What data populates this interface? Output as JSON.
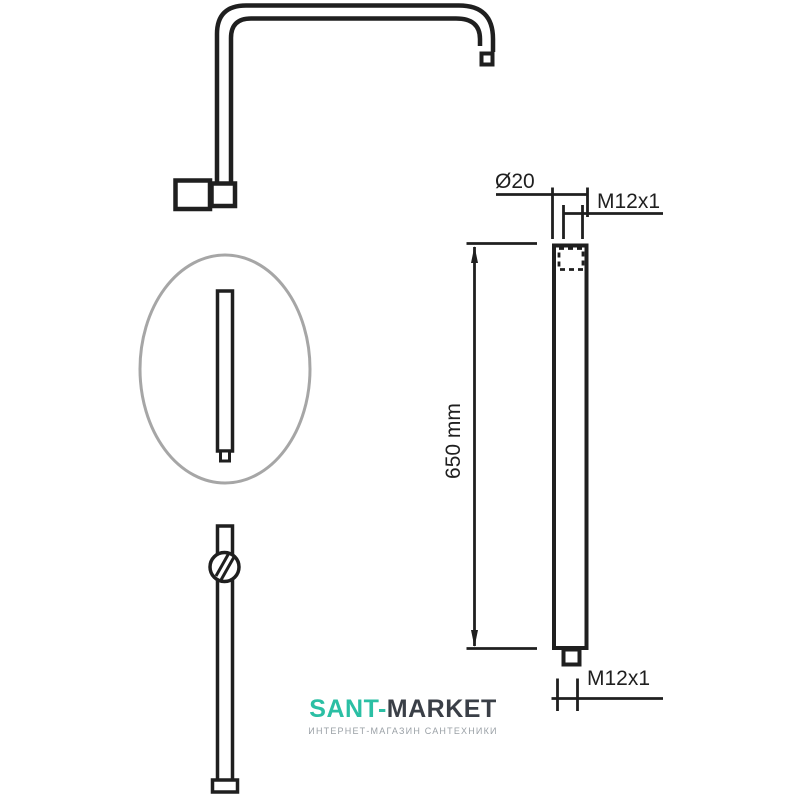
{
  "colors": {
    "background": "#ffffff",
    "line": "#1f1f1f",
    "ellipse": "#a6a6a6",
    "brand": "#2bbfa4",
    "brand_dark": "#3a3f47",
    "tagline": "#9aa0a6"
  },
  "diagram": {
    "labels": {
      "diameter_top": "Ø20",
      "thread_top": "M12x1",
      "length": "650 mm",
      "thread_bottom": "M12x1"
    }
  },
  "logo": {
    "brand_primary": "SANT-",
    "brand_secondary": "MARKET",
    "tagline": "ИНТЕРНЕТ-МАГАЗИН САНТЕХНИКИ"
  }
}
